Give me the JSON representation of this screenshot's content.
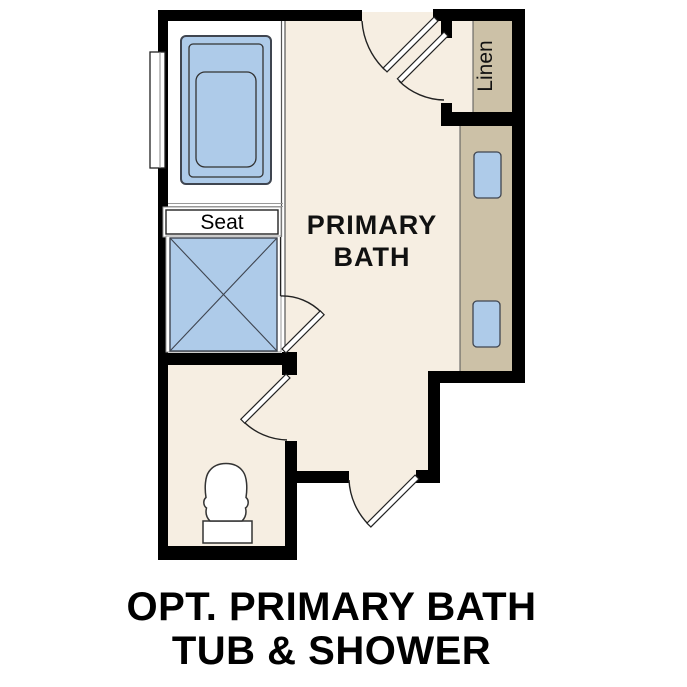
{
  "floor_plan": {
    "room_label_line1": "PRIMARY",
    "room_label_line2": "BATH",
    "seat_label": "Seat",
    "linen_label": "Linen"
  },
  "caption": {
    "line1": "OPT. PRIMARY BATH",
    "line2": "TUB & SHOWER"
  },
  "colors": {
    "wall": "#000000",
    "floor_main": "#f6eee2",
    "floor_wet_area": "#ffffff",
    "cabinetry_tan": "#ccc1a7",
    "fixture_blue": "#aecbe9",
    "fixture_outline": "#3f4550",
    "door_line": "#222222"
  }
}
